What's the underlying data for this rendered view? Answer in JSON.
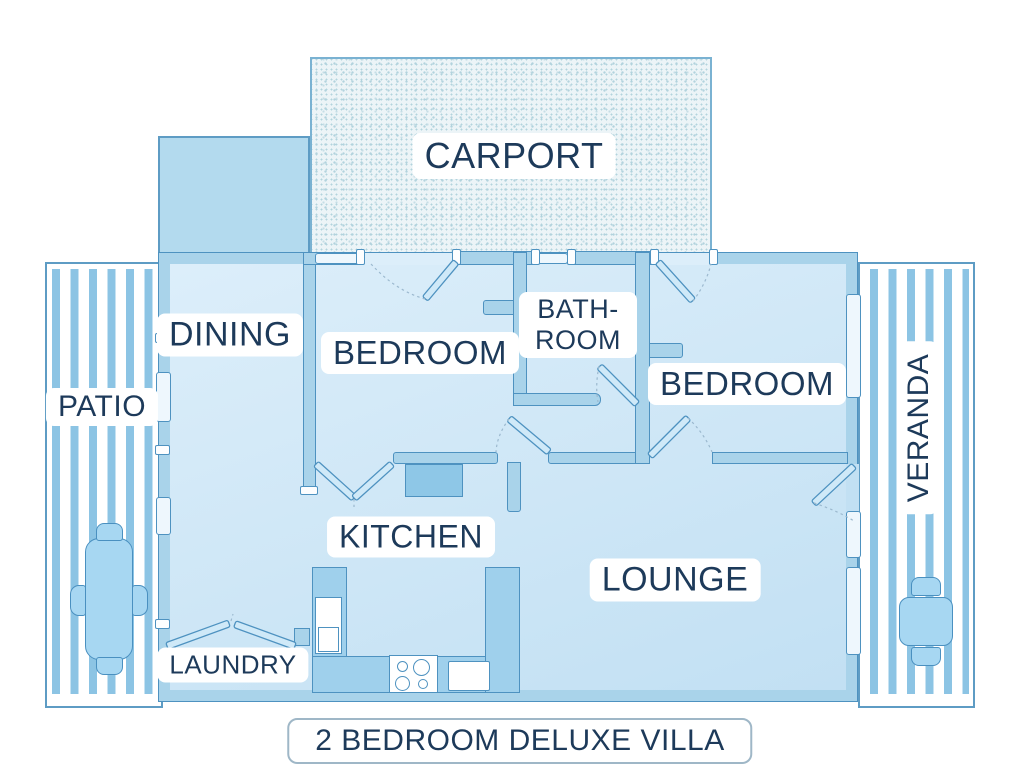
{
  "title_plate": {
    "text": "2 BEDROOM DELUXE VILLA"
  },
  "areas": {
    "carport": {
      "label": "CARPORT"
    },
    "patio": {
      "label": "PATIO"
    },
    "veranda": {
      "label": "VERANDA"
    },
    "dining": {
      "label": "DINING"
    },
    "bedroom_left": {
      "label": "BEDROOM"
    },
    "bathroom": {
      "label_line1": "BATH-",
      "label_line2": "ROOM"
    },
    "bedroom_right": {
      "label": "BEDROOM"
    },
    "kitchen": {
      "label": "KITCHEN"
    },
    "lounge": {
      "label": "LOUNGE"
    },
    "laundry": {
      "label": "LAUNDRY"
    }
  },
  "colors": {
    "wall": "#a9d3ea",
    "wall2": "#b3daee",
    "wall_line": "#4e92c0",
    "floor_a": "#dceefa",
    "floor_b": "#c2e0f3",
    "stripe": "#8cc4e4",
    "edge": "#5e9cc4",
    "ink": "#1d3a5a",
    "furn": "#a7d7f2",
    "furn_line": "#4a90c0",
    "counter": "#9fd0ec",
    "unit": "#8ec7e7",
    "win_bg": "#eef7fd",
    "carport_bg": "#ecf4f7",
    "carport_dot": "#b2d3dd",
    "carport_dot2": "#c6dde5",
    "carport_line": "#7ab2d2",
    "title_border": "#9fb7c7"
  }
}
